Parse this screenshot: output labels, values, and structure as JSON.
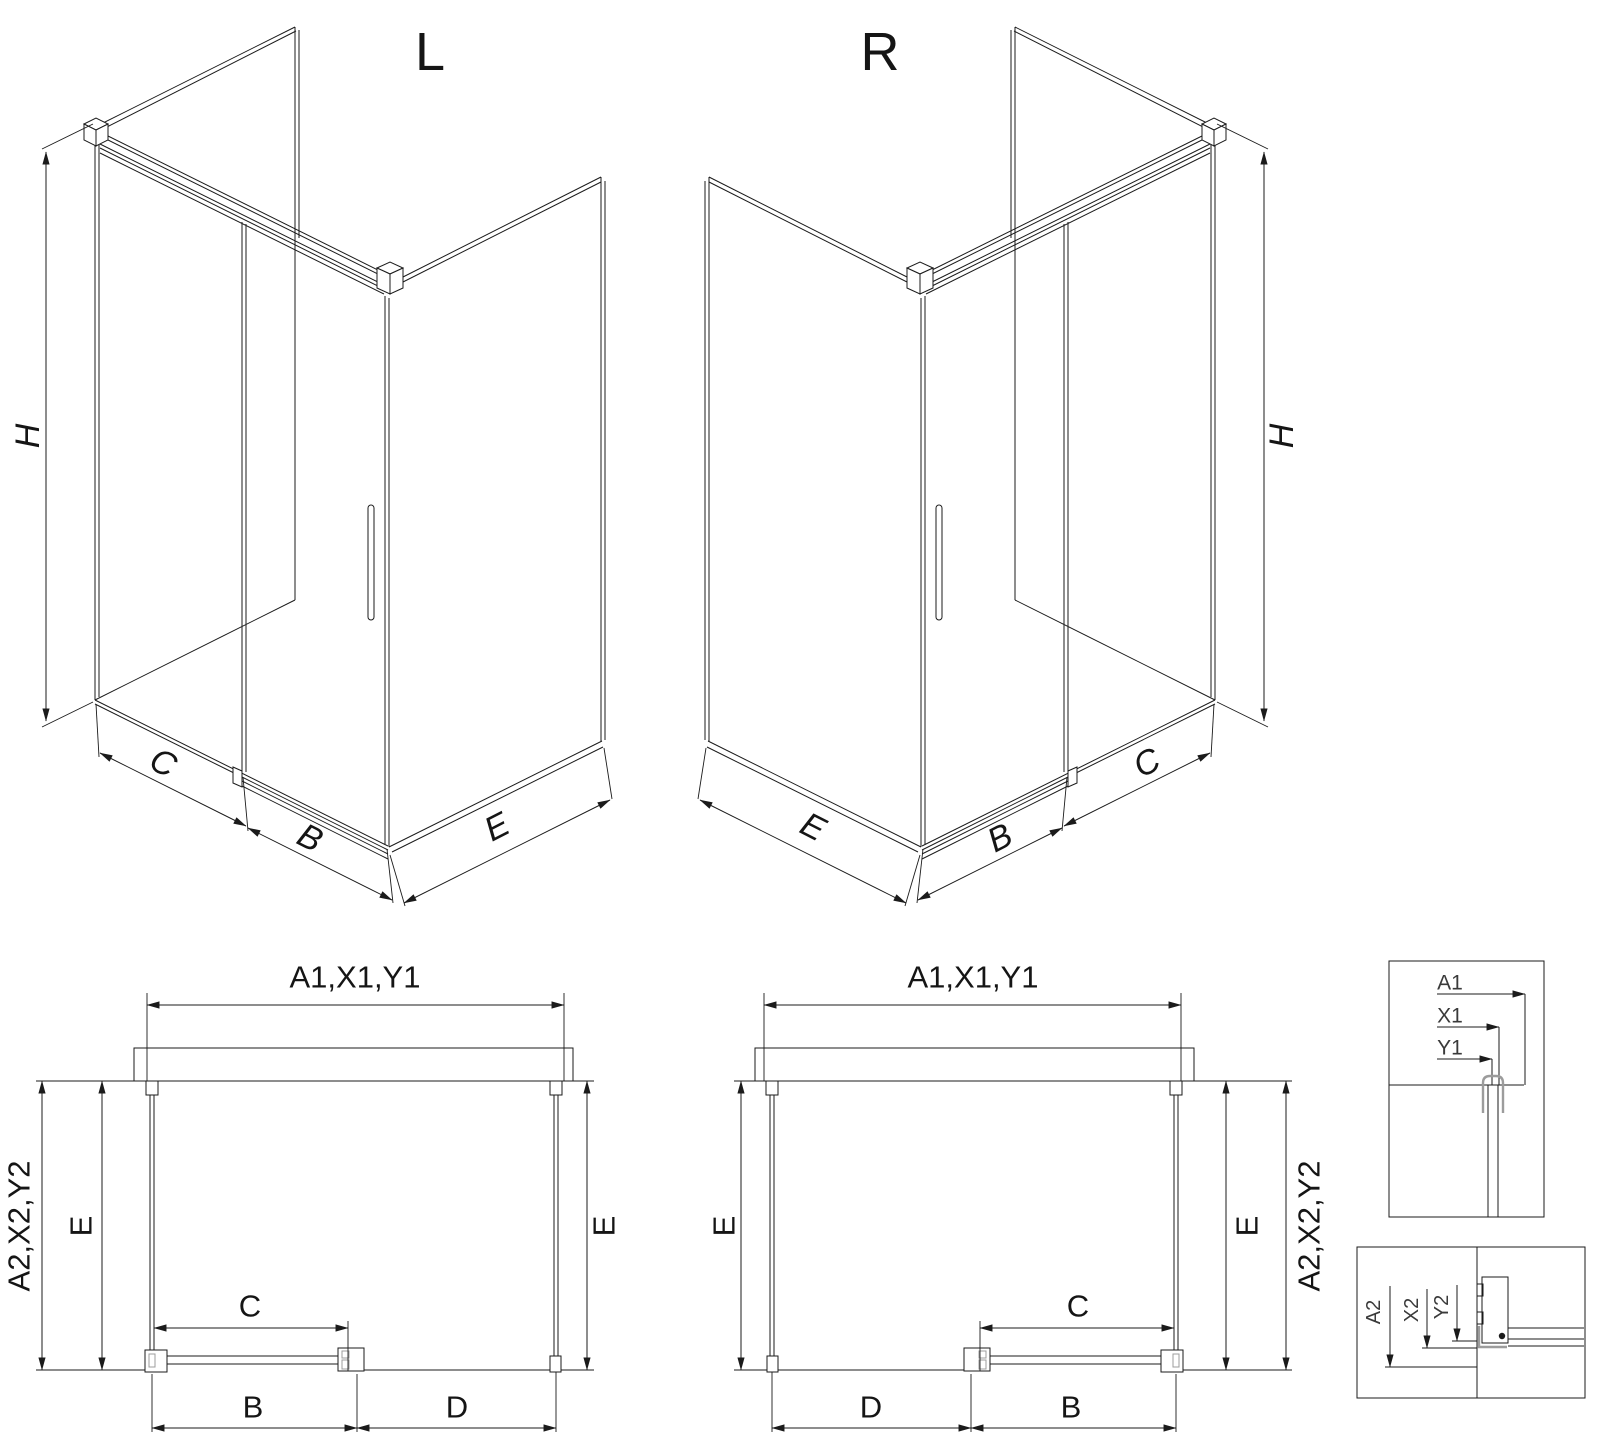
{
  "drawing": {
    "iso_left": {
      "title": "L",
      "dim_height": "H",
      "dim_fixed": "C",
      "dim_door": "B",
      "dim_side": "E"
    },
    "iso_right": {
      "title": "R",
      "dim_height": "H",
      "dim_fixed": "C",
      "dim_door": "B",
      "dim_side": "E"
    },
    "plan_left": {
      "dim_width_top": "A1,X1,Y1",
      "dim_depth_outer": "A2,X2,Y2",
      "dim_e_left": "E",
      "dim_e_right": "E",
      "dim_c": "C",
      "dim_b": "B",
      "dim_d": "D"
    },
    "plan_right": {
      "dim_width_top": "A1,X1,Y1",
      "dim_depth_outer": "A2,X2,Y2",
      "dim_e_left": "E",
      "dim_e_right": "E",
      "dim_c": "C",
      "dim_b": "B",
      "dim_d": "D"
    },
    "detail_top": {
      "dim_a1": "A1",
      "dim_x1": "X1",
      "dim_y1": "Y1"
    },
    "detail_bottom": {
      "dim_a2": "A2",
      "dim_x2": "X2",
      "dim_y2": "Y2"
    }
  }
}
